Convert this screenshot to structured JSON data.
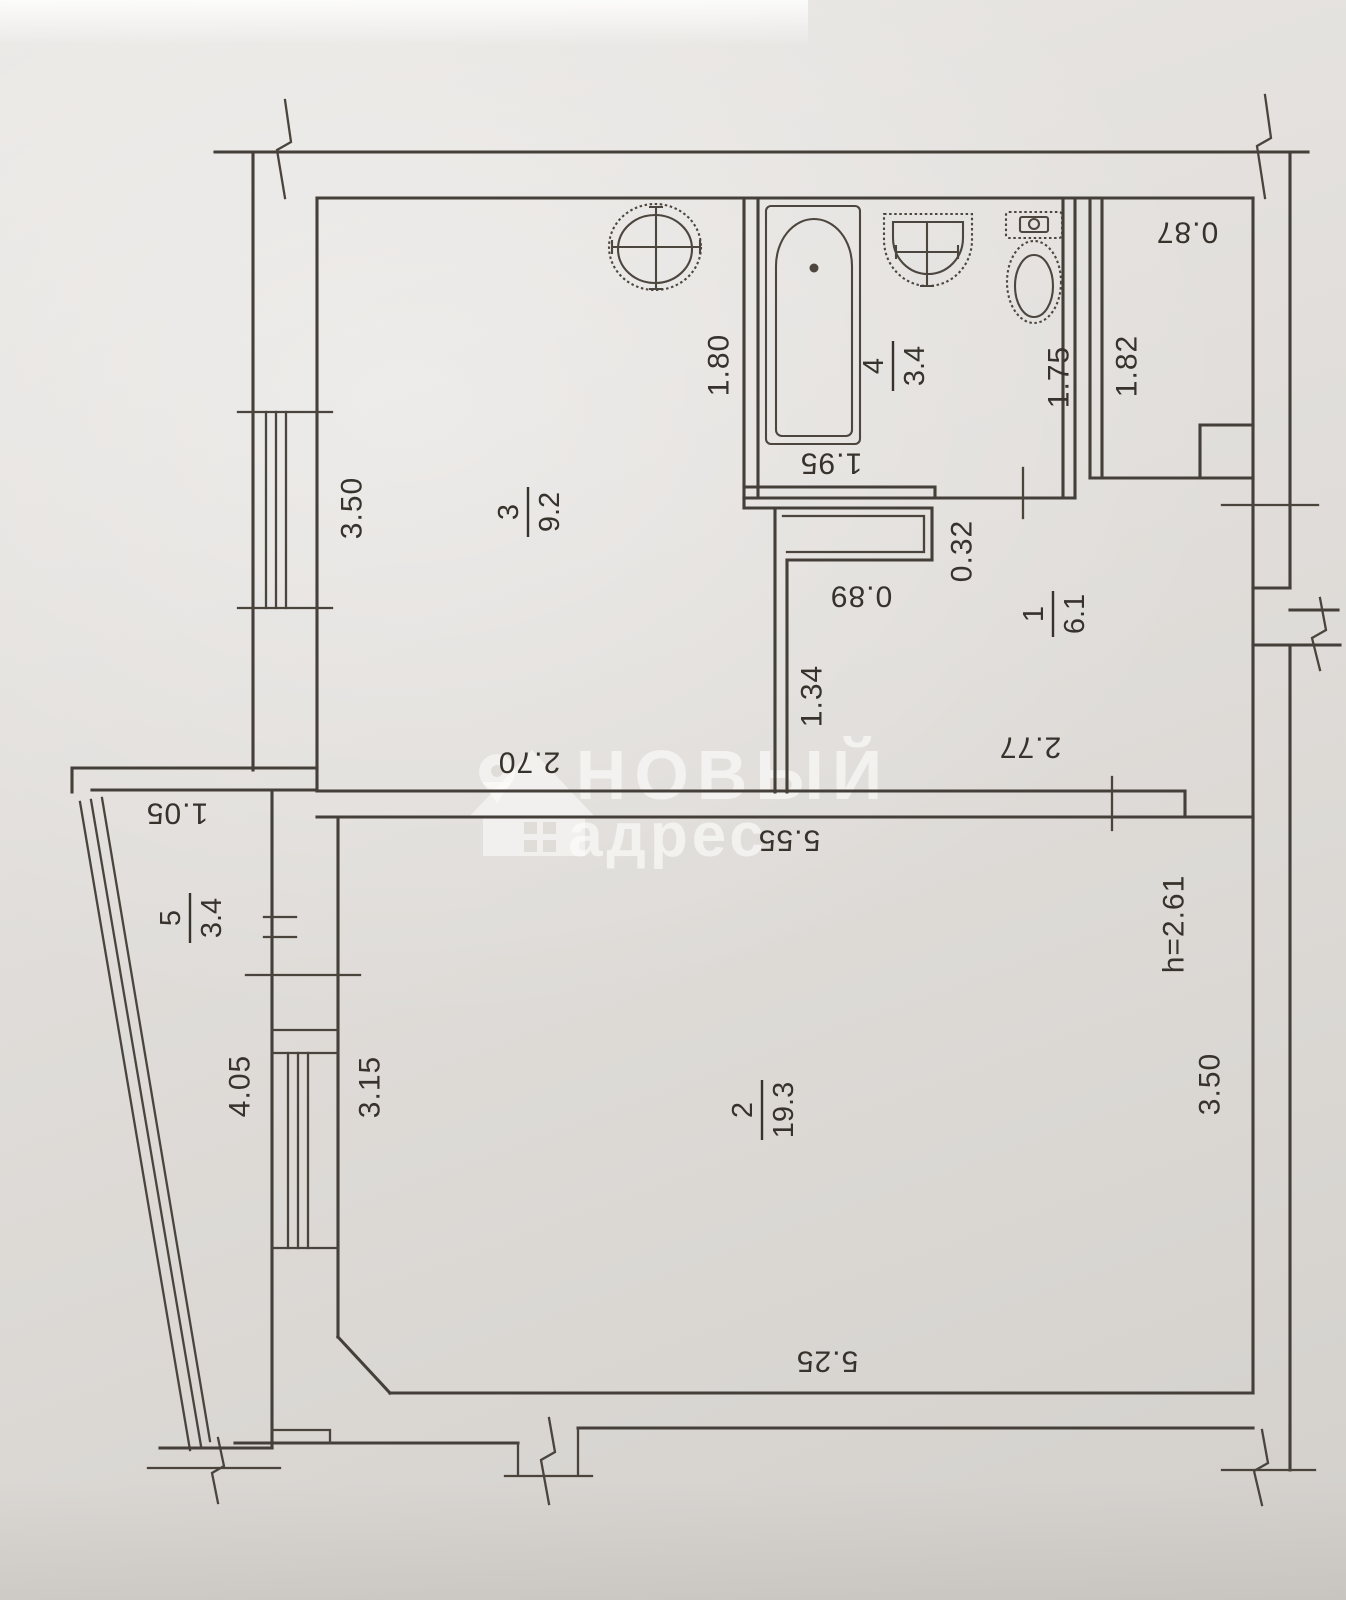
{
  "watermark": {
    "brand_top": "НОВЫЙ",
    "brand_bottom": "адрес"
  },
  "rooms": [
    {
      "number": "1",
      "area": "6.1"
    },
    {
      "number": "2",
      "area": "19.3"
    },
    {
      "number": "3",
      "area": "9.2"
    },
    {
      "number": "4",
      "area": "3.4"
    },
    {
      "number": "5",
      "area": "3.4"
    }
  ],
  "dims": {
    "closet_width": "0.87",
    "closet_depth": "1.82",
    "kitchen_depth": "3.50",
    "kitchen_width": "2.70",
    "bathroom_depth_left": "1.80",
    "bathroom_depth_right": "1.75",
    "bathroom_width": "1.95",
    "duct_width": "0.89",
    "duct_depth": "0.32",
    "hall_wall_length": "1.34",
    "hall_width": "2.77",
    "living_width_top": "5.55",
    "living_width_bottom": "5.25",
    "living_depth": "3.50",
    "living_left_segment": "3.15",
    "balcony_width": "1.05",
    "balcony_length": "4.05"
  },
  "notes": {
    "ceiling_height": "h=2.61"
  }
}
